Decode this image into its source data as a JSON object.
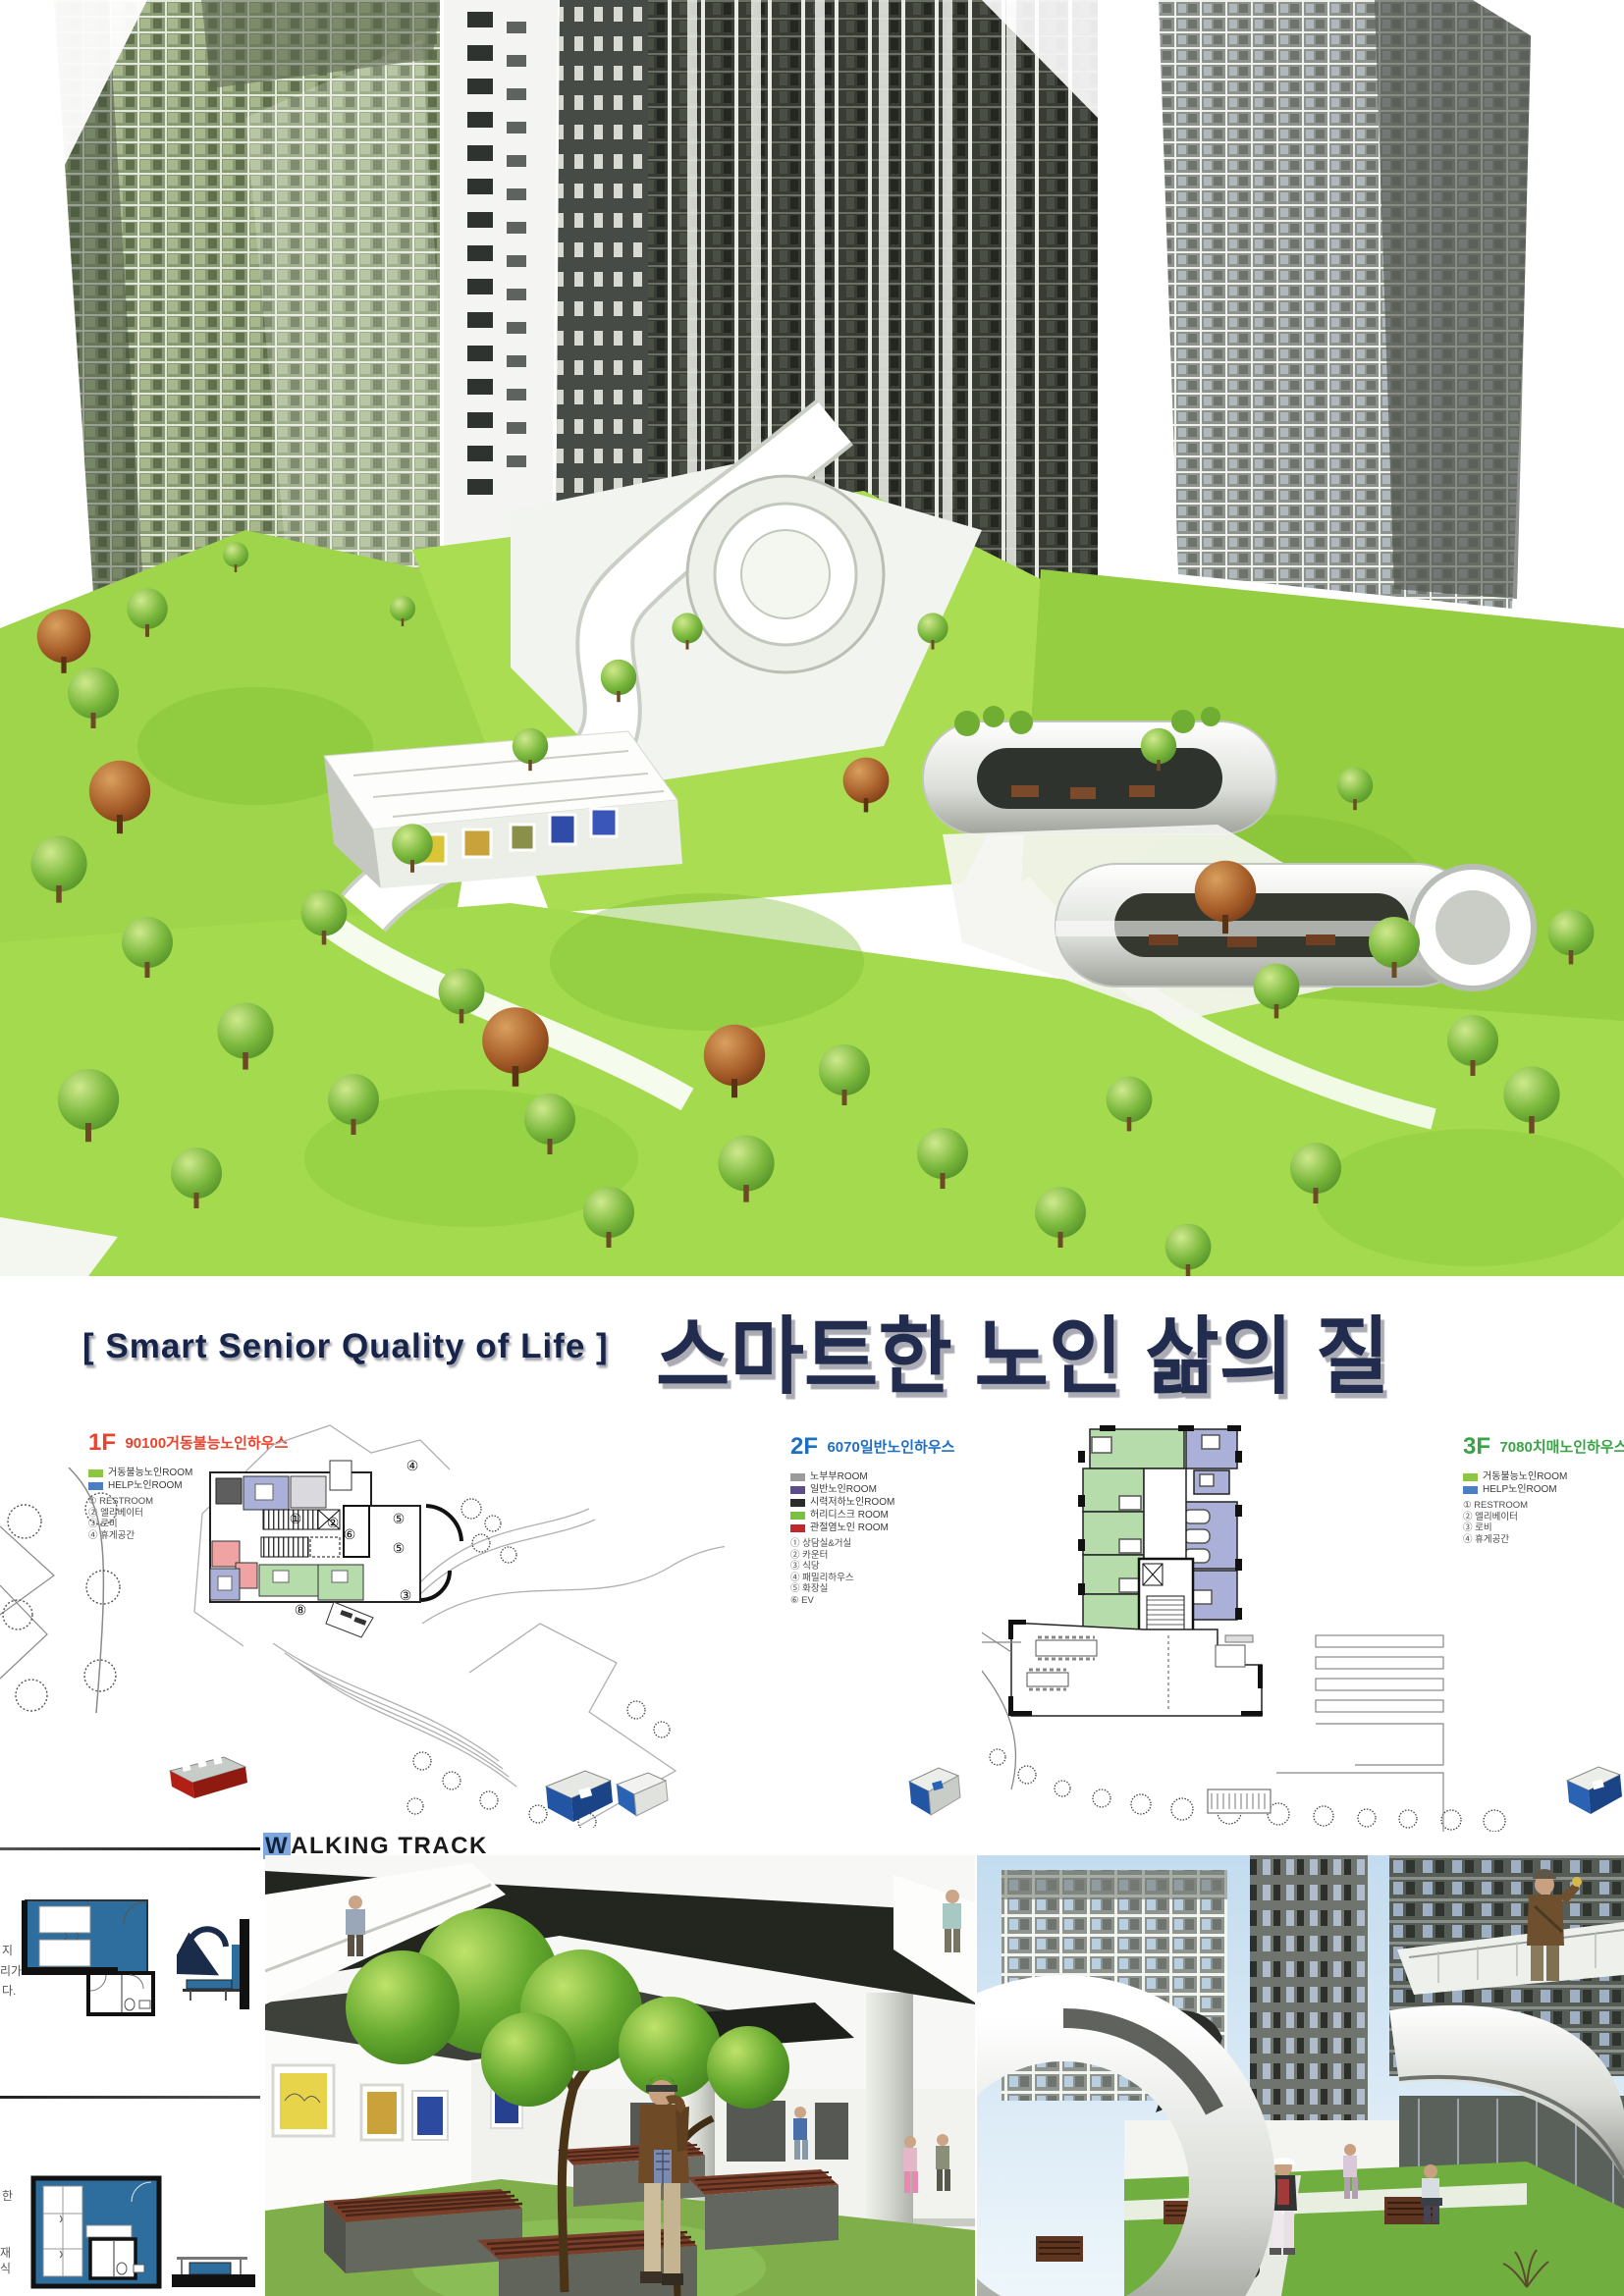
{
  "title": {
    "en": "[ Smart Senior Quality of Life ]",
    "ko": "스마트한 노인 삶의 질",
    "color": "#222c4e"
  },
  "plans": {
    "f1": {
      "floor": "1F",
      "name": "90100거동불능노인하우스",
      "accent": "#e8432c",
      "legend_rooms": [
        {
          "color": "#8dc63f",
          "label": "거동불능노인ROOM"
        },
        {
          "color": "#4a7fc1",
          "label": "HELP노인ROOM"
        }
      ],
      "legend_items": [
        "① RESTROOM",
        "② 엘리베이터",
        "③ 로비",
        "④ 휴게공간"
      ],
      "plan_markers": [
        "①",
        "②",
        "④",
        "⑤",
        "⑤",
        "⑥",
        "③",
        "⑧"
      ]
    },
    "f2": {
      "floor": "2F",
      "name": "6070일반노인하우스",
      "accent": "#1f6fc0",
      "legend_rooms": [
        {
          "color": "#9b9b9b",
          "label": "노부부ROOM"
        },
        {
          "color": "#5d4b8c",
          "label": "일반노인ROOM"
        },
        {
          "color": "#2b2b2b",
          "label": "시력저하노인ROOM"
        },
        {
          "color": "#7ac143",
          "label": "허리디스크 ROOM"
        },
        {
          "color": "#c1272d",
          "label": "관절염노인 ROOM"
        }
      ],
      "legend_items": [
        "① 상담실&거실",
        "② 카운터",
        "③ 식당",
        "④ 패밀리하우스",
        "⑤ 화장실",
        "⑥ EV"
      ]
    },
    "f3": {
      "floor": "3F",
      "name": "7080치매노인하우스",
      "accent": "#3aa348",
      "legend_rooms": [
        {
          "color": "#8dc63f",
          "label": "거동불능노인ROOM"
        },
        {
          "color": "#4a7fc1",
          "label": "HELP노인ROOM"
        }
      ],
      "legend_items": [
        "① RESTROOM",
        "② 엘리베이터",
        "③ 로비",
        "④ 휴게공간"
      ]
    },
    "room_colors": {
      "green": "#b7dcab",
      "purple": "#aab0d8",
      "pink": "#f0a3a3",
      "gray": "#5e5e5e"
    }
  },
  "walking_track": {
    "first_letter": "W",
    "rest": "ALKING TRACK",
    "highlight": "#7da7e0"
  },
  "side_notes": {
    "upper_fragments": [
      "지",
      "리가",
      "다."
    ],
    "lower_fragments": [
      "한",
      "재",
      "식"
    ],
    "diagram_blue": "#2e6e9e"
  }
}
